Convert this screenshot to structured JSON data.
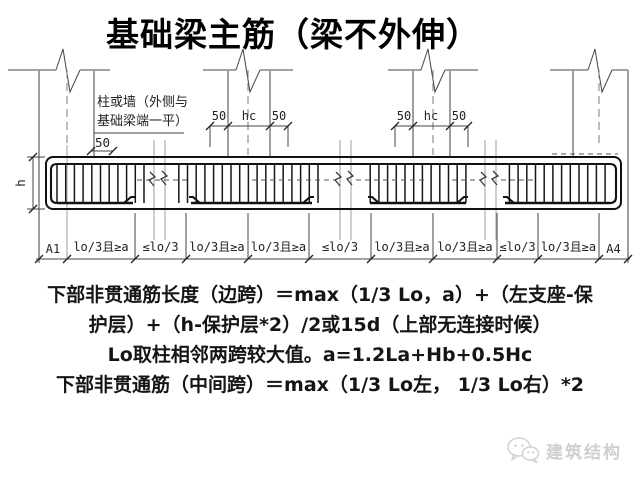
{
  "title": "基础梁主筋（梁不外伸）",
  "diagram": {
    "column_note": {
      "line1": "柱或墙（外侧与",
      "line2": "基础梁端一平）"
    },
    "left_cover_dim": "50",
    "column2_dim": {
      "left": "50",
      "mid": "hc",
      "right": "50"
    },
    "column3_dim": {
      "left": "50",
      "mid": "hc",
      "right": "50"
    },
    "beam_height": "h",
    "bottom_dims": [
      "A1",
      "lo/3且≥a",
      "≤lo/3",
      "lo/3且≥a",
      "lo/3且≥a",
      "≤lo/3",
      "lo/3且≥a",
      "lo/3且≥a",
      "≤lo/3",
      "lo/3且≥a",
      "A4"
    ]
  },
  "notes": [
    "下部非贯通筋长度（边跨）＝max（1/3 Lo，a）+（左支座-保",
    "护层）+（h-保护层*2）/2或15d（上部无连接时候）",
    "Lo取柱相邻两跨较大值。a=1.2La+Hb+0.5Hc",
    "下部非贯通筋（中间跨）＝max（1/3 Lo左， 1/3 Lo右）*2"
  ],
  "watermark": {
    "label": "建筑结构"
  },
  "colors": {
    "line": "#111111",
    "column_gray": "#9a9a9a",
    "watermark": "#cfcfcf",
    "background": "#ffffff"
  }
}
